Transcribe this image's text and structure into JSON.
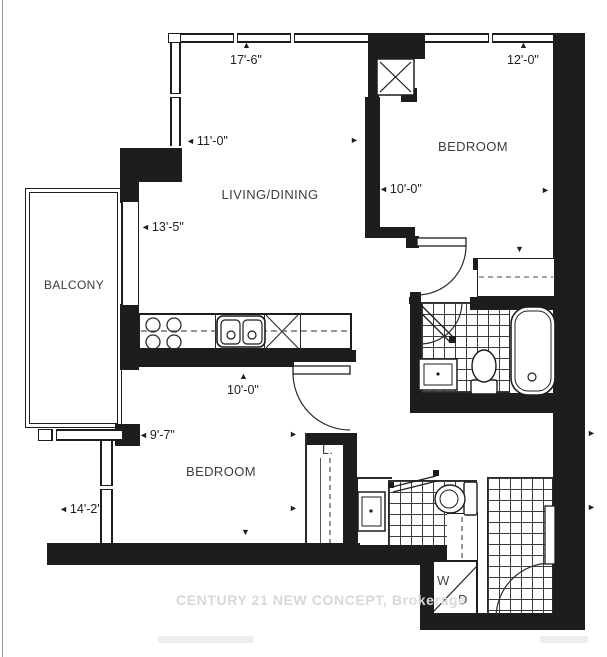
{
  "floorplan": {
    "rooms": {
      "living": "LIVING/DINING",
      "bedroom1": "BEDROOM",
      "bedroom2": "BEDROOM",
      "balcony": "BALCONY",
      "linen": "L.",
      "washer": "W",
      "dryer": "D"
    },
    "dimensions": {
      "top_window_living": "17'-6\"",
      "top_window_bedroom": "12'-0\"",
      "living_width": "11'-0\"",
      "bedroom1_width": "10'-0\"",
      "living_height": "13'-5\"",
      "kitchen_width": "10'-0\"",
      "bedroom2_window": "9'-7\"",
      "bedroom2_width": "14'-2\""
    },
    "icons": {
      "arrow_left": "◄",
      "arrow_right": "►",
      "arrow_up": "▲",
      "arrow_down": "▼"
    },
    "watermark": "CENTURY 21 NEW CONCEPT, Brokerage",
    "colors": {
      "wall": "#1f1c1d",
      "line": "#2a2a2a",
      "watermark": "#d8d8d8"
    }
  }
}
